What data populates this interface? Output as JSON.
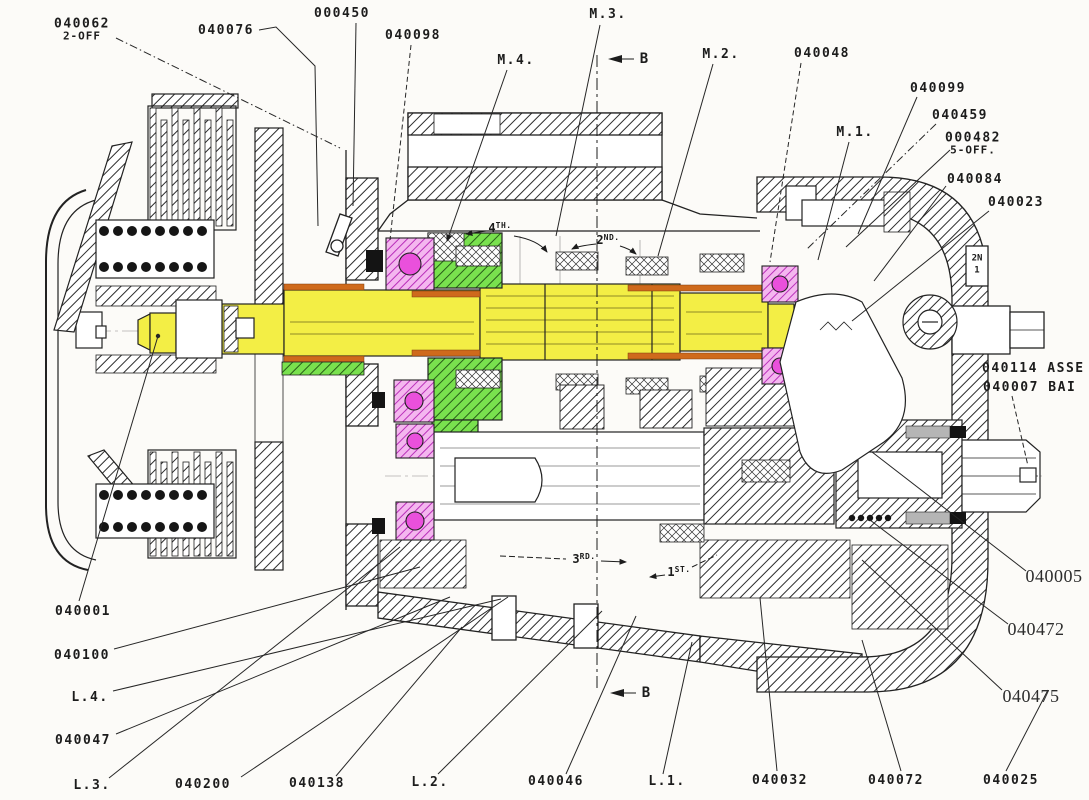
{
  "drawing": {
    "description": "Sectional engineering drawing of a motorcycle gearbox with clutch, colour-highlighted shafts, gears and bearings, and part-number callouts",
    "colors": {
      "background": "#fcfbf8",
      "line": "#222222",
      "shaft_yellow": "#f3ee45",
      "gear_green": "#79e14e",
      "bearing_pink": "#f4b6ef",
      "bearing_ball_magenta": "#ea50dc",
      "bush_orange": "#cf6a1c",
      "seal_gray": "#b5b5b5"
    },
    "part_labels": [
      {
        "id": "040062",
        "text": "040062",
        "sub": "2-OFF",
        "x": 82,
        "y": 30
      },
      {
        "id": "040076",
        "text": "040076",
        "x": 226,
        "y": 31
      },
      {
        "id": "000450",
        "text": "000450",
        "x": 342,
        "y": 14
      },
      {
        "id": "040098",
        "text": "040098",
        "x": 413,
        "y": 36
      },
      {
        "id": "m4",
        "text": "M.4.",
        "x": 516,
        "y": 61
      },
      {
        "id": "m3",
        "text": "M.3.",
        "x": 608,
        "y": 15
      },
      {
        "id": "m2",
        "text": "M.2.",
        "x": 721,
        "y": 55
      },
      {
        "id": "040048",
        "text": "040048",
        "x": 822,
        "y": 54
      },
      {
        "id": "040099",
        "text": "040099",
        "x": 938,
        "y": 89
      },
      {
        "id": "m1",
        "text": "M.1.",
        "x": 855,
        "y": 133
      },
      {
        "id": "040459",
        "text": "040459",
        "x": 960,
        "y": 116
      },
      {
        "id": "000482",
        "text": "000482",
        "sub": "5-OFF.",
        "x": 973,
        "y": 144
      },
      {
        "id": "040084",
        "text": "040084",
        "x": 975,
        "y": 180
      },
      {
        "id": "040023",
        "text": "040023",
        "x": 1016,
        "y": 203
      },
      {
        "id": "040114",
        "text": "040114 ASSE",
        "x": 982,
        "y": 369,
        "anchor": "left"
      },
      {
        "id": "040007",
        "text": "040007 BAI",
        "x": 983,
        "y": 388,
        "anchor": "left"
      },
      {
        "id": "040001",
        "text": "040001",
        "x": 83,
        "y": 612
      },
      {
        "id": "040100",
        "text": "040100",
        "x": 82,
        "y": 656
      },
      {
        "id": "l4",
        "text": "L.4.",
        "x": 90,
        "y": 698
      },
      {
        "id": "040047",
        "text": "040047",
        "x": 83,
        "y": 741
      },
      {
        "id": "l3",
        "text": "L.3.",
        "x": 92,
        "y": 786
      },
      {
        "id": "040200",
        "text": "040200",
        "x": 203,
        "y": 785
      },
      {
        "id": "040138",
        "text": "040138",
        "x": 317,
        "y": 784
      },
      {
        "id": "l2",
        "text": "L.2.",
        "x": 430,
        "y": 783
      },
      {
        "id": "040046",
        "text": "040046",
        "x": 556,
        "y": 782
      },
      {
        "id": "l1",
        "text": "L.1.",
        "x": 667,
        "y": 782
      },
      {
        "id": "040032",
        "text": "040032",
        "x": 780,
        "y": 781
      },
      {
        "id": "040072",
        "text": "040072",
        "x": 896,
        "y": 781
      },
      {
        "id": "040025",
        "text": "040025",
        "x": 1011,
        "y": 781
      },
      {
        "id": "040005",
        "text": "040005",
        "x": 1054,
        "y": 577,
        "style": "serif"
      },
      {
        "id": "040472",
        "text": "040472",
        "x": 1036,
        "y": 630,
        "style": "serif"
      },
      {
        "id": "040475",
        "text": "040475",
        "x": 1031,
        "y": 697,
        "style": "serif"
      }
    ],
    "gear_annotations": [
      {
        "id": "4th",
        "num": "4",
        "suffix": "TH.",
        "x": 500,
        "y": 228
      },
      {
        "id": "2nd",
        "num": "2",
        "suffix": "ND.",
        "x": 608,
        "y": 240
      },
      {
        "id": "3rd",
        "num": "3",
        "suffix": "RD.",
        "x": 584,
        "y": 559
      },
      {
        "id": "1st",
        "num": "1",
        "suffix": "ST.",
        "x": 679,
        "y": 572
      }
    ],
    "section_markers": [
      {
        "id": "b-top",
        "text": "B",
        "x": 644,
        "y": 59
      },
      {
        "id": "b-bottom",
        "text": "B",
        "x": 646,
        "y": 693
      }
    ],
    "plate_tag": {
      "lines": [
        "2N",
        "1"
      ],
      "x": 977,
      "y": 265
    }
  }
}
